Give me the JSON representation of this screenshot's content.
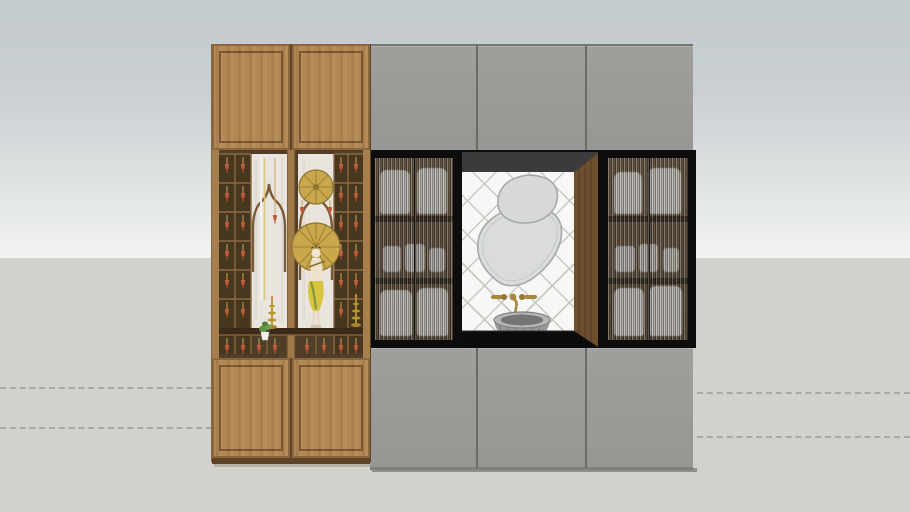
{
  "scene": {
    "type": "3d-model-front-elevation",
    "description": "Front elevation of a carved wooden pooja unit beside a grey wall unit with fluted-glass display cabinets flanking a washbasin vanity niche",
    "viewport": {
      "width": 910,
      "height": 512,
      "sky_top_color": "#c4cbcf",
      "sky_horizon_color": "#f2f3f1",
      "ground_color": "#d2d1cc",
      "horizon_y": 258,
      "guide_line_style": "dashed",
      "guide_line_color": "#a2a29c"
    },
    "pooja_unit": {
      "wood_color": "#b28756",
      "frame_color": "#7a5a36",
      "solid_doors_top": 2,
      "solid_doors_bottom": 2,
      "jali_section": {
        "cell_backing_color": "#4a3926",
        "marble_color": "#e9e5de",
        "ogee_arches": 2,
        "hanging_bell_color": "#c25a3a",
        "decor_items": [
          "brass-pleated-fan-small",
          "brass-pleated-fan-large",
          "deity-figure",
          "brass-oil-lamp-left",
          "brass-oil-lamp-right",
          "potted-plant",
          "hanging-bells",
          "brass-rods"
        ]
      }
    },
    "wall_unit": {
      "panel_color": "#9a9a97",
      "upper_panels": 3,
      "lower_panels": 3,
      "fluted_cabinets": {
        "count": 2,
        "frame_color": "#0d0d0d",
        "glass_type": "fluted",
        "compartments_per_cabinet": 3,
        "contents": "stacked vessels and glassware"
      },
      "vanity_niche": {
        "tile_color": "#f7f7f5",
        "tile_pattern": "diamond-lattice",
        "grout_color": "#c8c8c4",
        "ceiling_color": "#3b3b3b",
        "side_panel_color": "#6d4e2f",
        "mirrors": {
          "count": 2,
          "shape": "organic-pebble",
          "fill": "#dadcdc",
          "edge": "#a6a9a9"
        },
        "faucet": {
          "finish_color": "#a8873e",
          "parts": [
            "left-handle",
            "wall-spout",
            "right-handle"
          ]
        },
        "sink": {
          "style": "scalloped-vessel-bowl",
          "color": "#9a9a98"
        },
        "counter_color": "#0c0c0c"
      }
    }
  }
}
